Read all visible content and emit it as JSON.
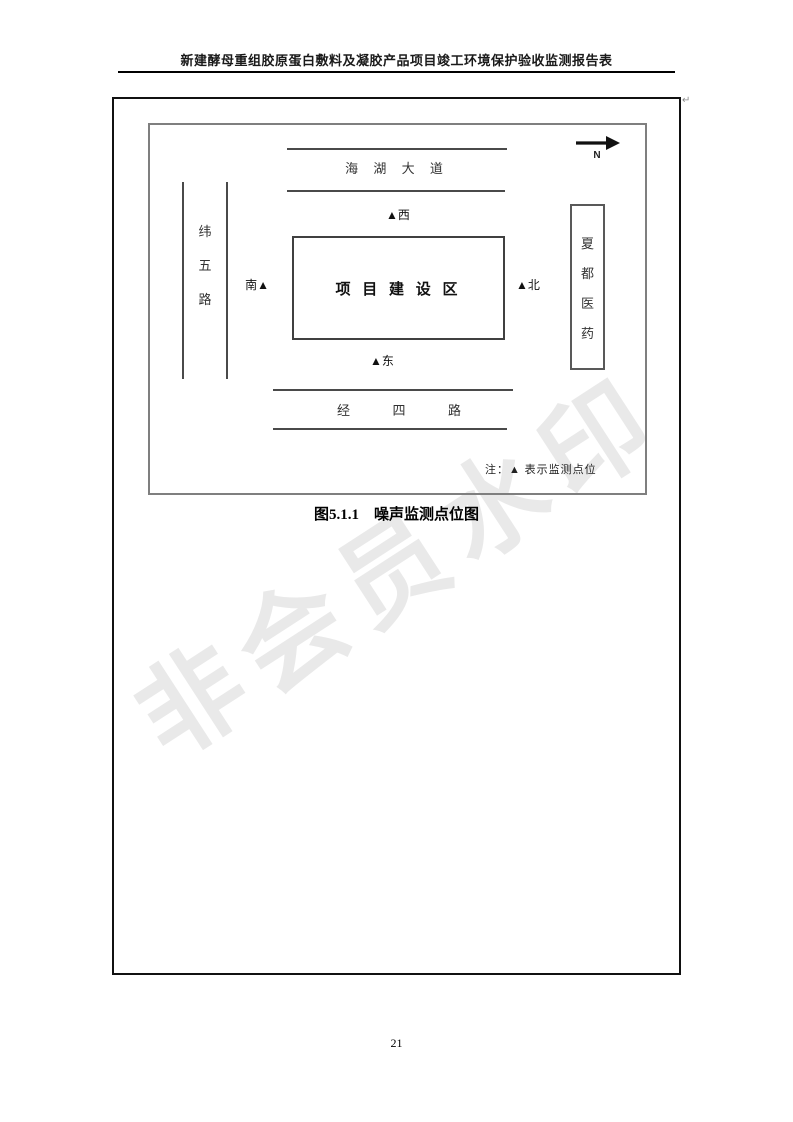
{
  "header": {
    "title": "新建酵母重组胶原蛋白敷料及凝胶产品项目竣工环境保护验收监测报告表"
  },
  "watermark": {
    "text": "非会员水印",
    "color": "#e9e9e9"
  },
  "paragraph_mark": "↵",
  "diagram": {
    "compass": {
      "label": "N"
    },
    "roads": {
      "top": "海 湖 大 道",
      "left_chars": [
        "纬",
        "五",
        "路"
      ],
      "bottom": "经  四  路"
    },
    "site": {
      "label": "项 目 建 设 区"
    },
    "building": {
      "chars": [
        "夏",
        "都",
        "医",
        "药"
      ]
    },
    "markers": {
      "west": "▲西",
      "south": "南▲",
      "north": "▲北",
      "east": "▲东"
    },
    "note": "注：▲ 表示监测点位",
    "caption": "图5.1.1    噪声监测点位图"
  },
  "footer": {
    "page_number": "21"
  },
  "colors": {
    "outer_border": "#111111",
    "inner_frame": "#7f7f7f",
    "road_line": "#4a4a4a",
    "watermark": "#e9e9e9",
    "text": "#1a1a1a"
  }
}
